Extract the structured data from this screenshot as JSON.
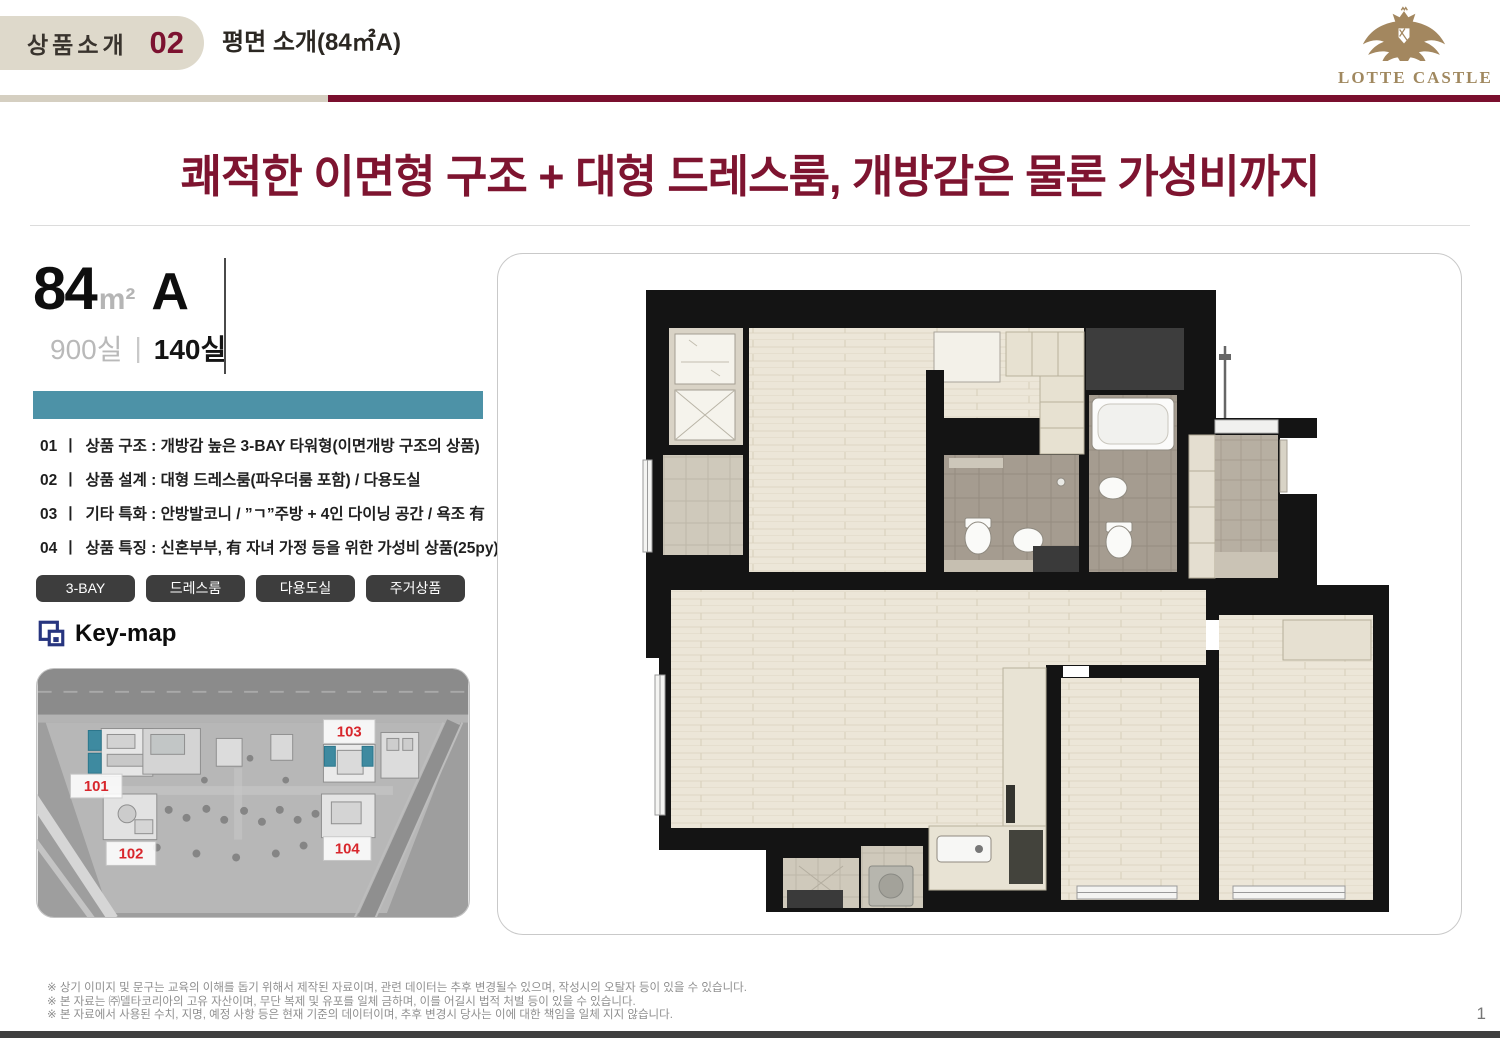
{
  "header": {
    "tab_label": "상품소개",
    "tab_number": "02",
    "page_title": "평면 소개(84㎡A)",
    "logo_text": "LOTTE CASTLE"
  },
  "headline": "쾌적한 이면형 구조 + 대형 드레스룸, 개방감은 물론 가성비까지",
  "unit_info": {
    "area": "84",
    "area_unit": "m²",
    "type": "A",
    "total_units": "900실",
    "separator": "|",
    "type_units": "140실"
  },
  "list_separator": "ㅣ",
  "features": [
    {
      "no": "01",
      "text": "상품 구조 : 개방감 높은 3-BAY 타워형(이면개방 구조의 상품)"
    },
    {
      "no": "02",
      "text": "상품 설계 : 대형 드레스룸(파우더룸 포함) / 다용도실"
    },
    {
      "no": "03",
      "text": "기타 특화 : 안방발코니 / ”ㄱ”주방 + 4인 다이닝 공간 / 욕조 有"
    },
    {
      "no": "04",
      "text": "상품 특징 : 신혼부부, 有 자녀 가정 등을 위한 가성비 상품(25py)"
    }
  ],
  "tags": [
    "3-BAY",
    "드레스룸",
    "다용도실",
    "주거상품"
  ],
  "keymap": {
    "title": "Key-map",
    "building_labels": [
      "101",
      "102",
      "103",
      "104"
    ]
  },
  "footer": {
    "disclaimers": [
      "※ 상기 이미지 및 문구는 교육의 이해를 돕기 위해서 제작된 자료이며, 관련 데이터는 추후 변경될수 있으며, 작성시의 오탈자 등이 있을 수 있습니다.",
      "※ 본 자료는 ㈜델타코리아의 고유 자산이며, 무단 복제 및 유포를 일체 금하며, 이를 어길시 법적 처벌 등이 있을 수 있습니다.",
      "※ 본 자료에서 사용된 수치, 지명, 예정 사항 등은 현재 기준의 데이터이며, 추후 변경시 당사는 이에 대한 책임을 일체 지지 않습니다."
    ],
    "page_number": "1"
  },
  "colors": {
    "accent_burgundy": "#7e1430",
    "header_rule_burgundy": "#7a0f2e",
    "header_pill_beige": "#ded9cb",
    "teal_bar": "#4d92a7",
    "tag_background": "#3d3d3d",
    "logo_gold": "#a0885f",
    "map_highlight_teal": "#3e8aa0",
    "map_label_red": "#d8262c"
  }
}
